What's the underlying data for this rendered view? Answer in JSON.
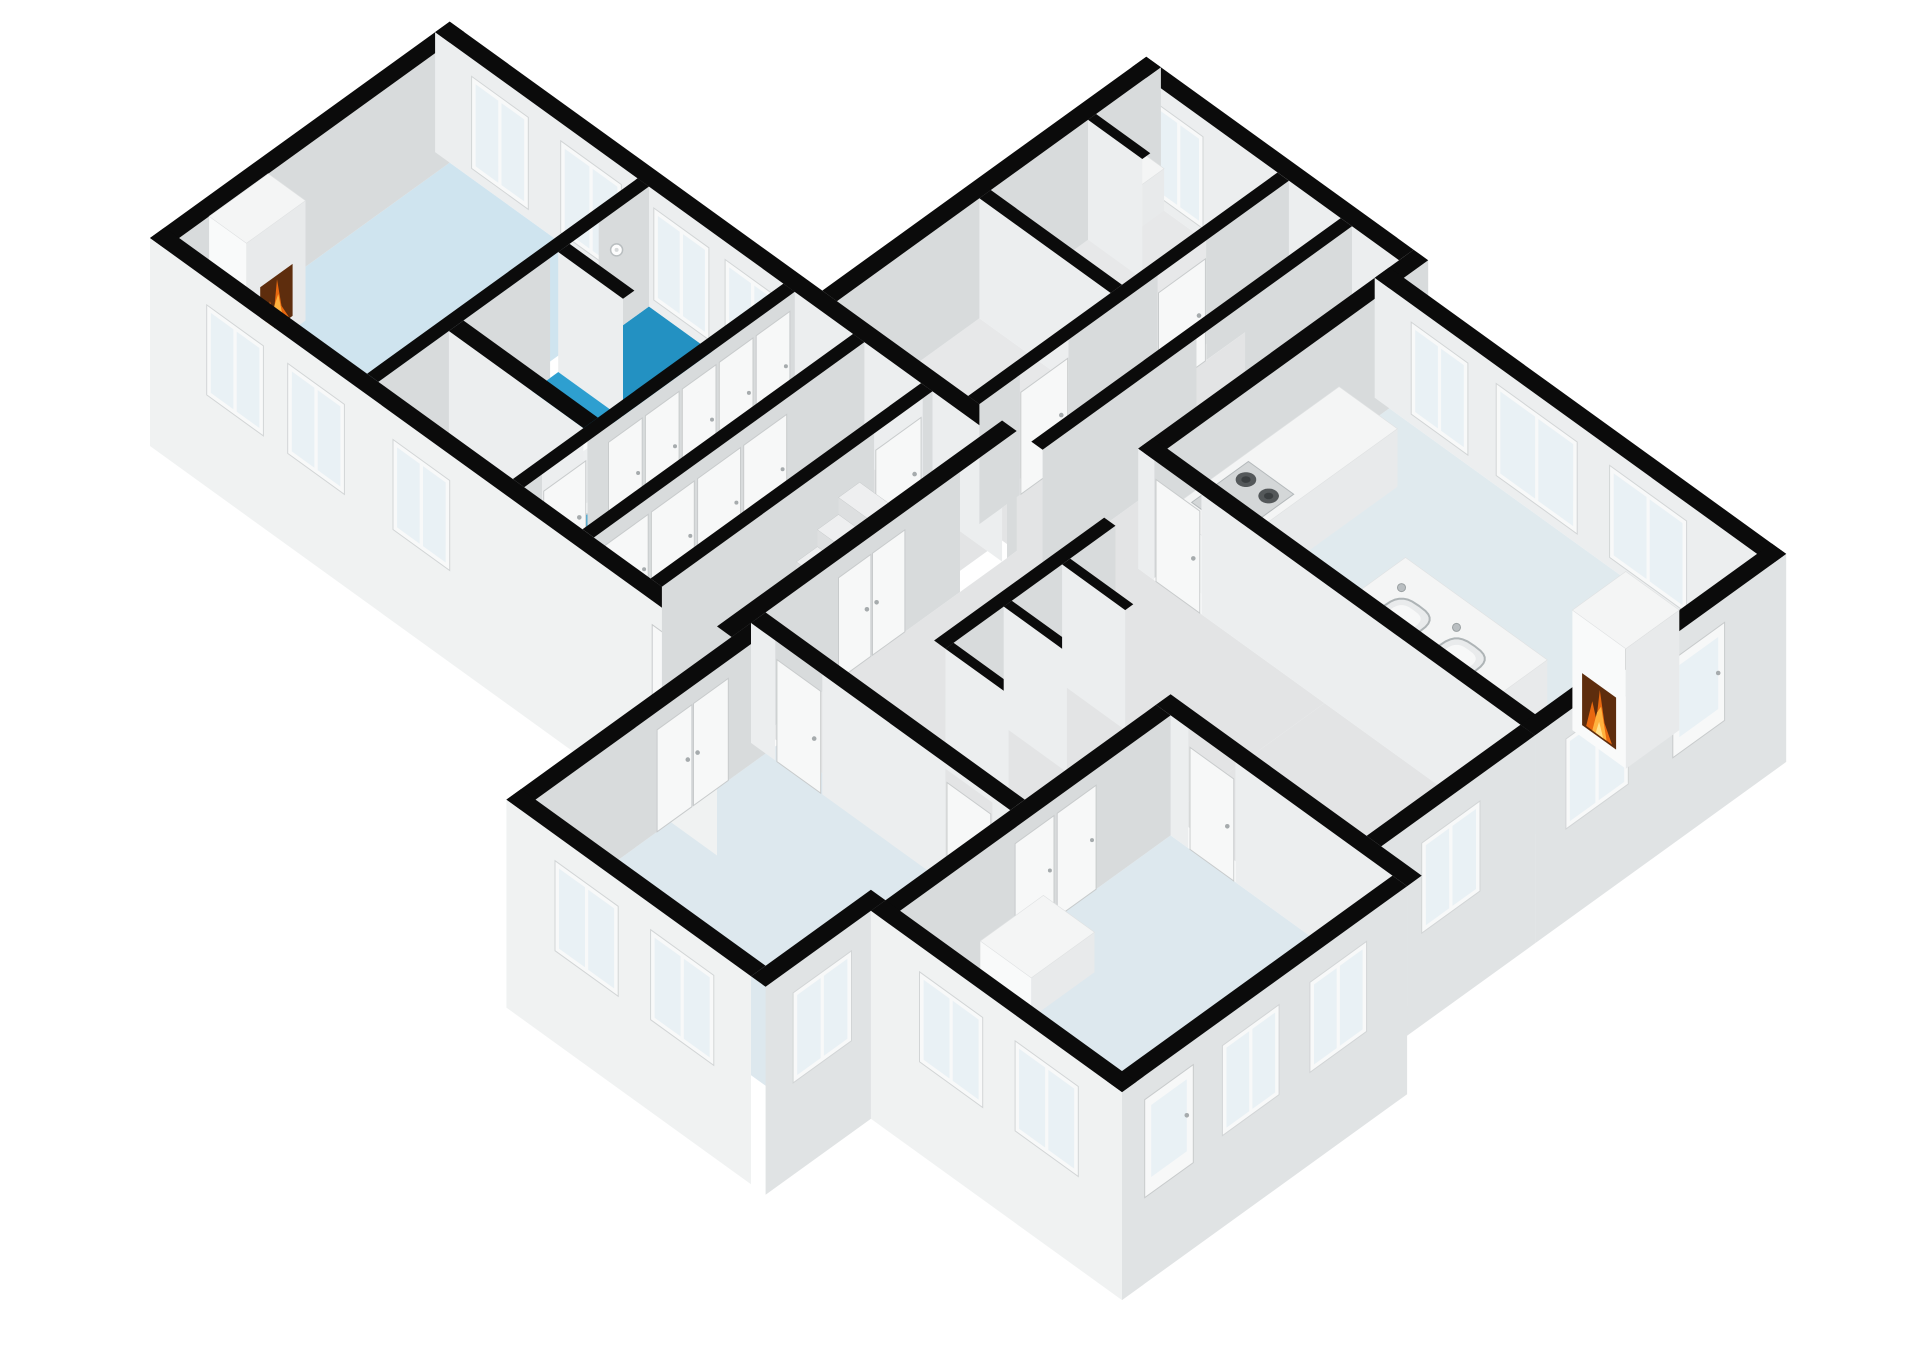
{
  "scene": {
    "label": "3D isometric floor plan rendering",
    "rooms": [
      {
        "name": "living-room",
        "floor": "floorLiving",
        "features": [
          "fireplace",
          "windows"
        ]
      },
      {
        "name": "bathroom",
        "floor": "floorBath",
        "features": [
          "bathtub",
          "shower-alcove",
          "shower-head"
        ]
      },
      {
        "name": "hall-strip",
        "floor": "floorGray",
        "features": [
          "window"
        ]
      },
      {
        "name": "wardrobe-corridor-1",
        "floor": "floorGray",
        "features": [
          "closet-doors"
        ]
      },
      {
        "name": "wardrobe-corridor-2",
        "floor": "floorGray",
        "features": [
          "closet-doors"
        ]
      },
      {
        "name": "stair-hall",
        "floor": "floorGray",
        "features": [
          "staircase",
          "red-decor",
          "exterior-door"
        ]
      },
      {
        "name": "small-room-a",
        "floor": "floorRoomGray",
        "features": [
          "door"
        ]
      },
      {
        "name": "small-room-b",
        "floor": "floorRoomGray",
        "features": [
          "storage-nook",
          "window"
        ]
      },
      {
        "name": "connecting-corridor",
        "floor": "floorGray",
        "features": [
          "doors"
        ]
      },
      {
        "name": "kitchen",
        "floor": "floorKitchen",
        "features": [
          "counter",
          "stove",
          "island",
          "double-sink",
          "fireplace",
          "windows",
          "glass-door"
        ]
      },
      {
        "name": "bottom-center-room",
        "floor": "floorRoom",
        "features": [
          "double-door",
          "windows"
        ]
      },
      {
        "name": "bottom-right-room",
        "floor": "floorRoom",
        "features": [
          "closet",
          "chest",
          "windows",
          "glass-door"
        ]
      }
    ]
  },
  "projection": {
    "x0": 150,
    "y0": 358,
    "kx": 0.81,
    "ky": 0.585,
    "wall_h": 120,
    "plinth": 88
  },
  "colors": {
    "bg": "#ffffff",
    "wallTop": "#0b0b0b",
    "faceSE": "#d8dbdc",
    "faceSW": "#eceeef",
    "extSE": "#e0e3e4",
    "extSW": "#f0f2f2",
    "boxTop": "#f4f5f5",
    "boxSW": "#f9fafa",
    "boxSE": "#e8eaeb",
    "redTop": "#d14b36",
    "redSW": "#c43b2a",
    "redSE": "#a93225",
    "floorLiving": "#cfe4ef",
    "floorBath": "#2e9fd0",
    "floorAlcove": "#2391c2",
    "floorGray": "#e3e4e5",
    "floorRoomGray": "#e7e8e9",
    "floorKitchen": "#e0eaee",
    "floorRoom": "#dde8ee",
    "glass": "#e9f1f5",
    "frame": "#f8f9f9",
    "frameEdge": "#d2d5d6",
    "doorFill": "#f7f8f8",
    "doorEdge": "#c8cbcc",
    "handle": "#a6abad",
    "stairTop": "#eeeff0",
    "stairFaceSW": "#dddfe0",
    "stairFaceSE": "#d2d4d5",
    "fireDark": "#5e2d0d",
    "fireMid": "#e8680f",
    "fireLight": "#ffb23e",
    "fireCore": "#ffe08a",
    "tubFill": "#fcfdfd",
    "tubEdge": "#cdd1d2",
    "tubInner": "#edeff0",
    "steel": "#b9bec1",
    "cooktop": "#d4d7d8",
    "burner": "#54585a",
    "burnerIn": "#3a3e40",
    "sinkRim": "#aeb4b6",
    "sinkIn": "#e9ebec",
    "sinkBowl": "#f7f8f8"
  },
  "elements": [
    {
      "kind": "floor",
      "name": "living-room-floor",
      "r": [
        18,
        18,
        352,
        250
      ],
      "c": "floorLiving"
    },
    {
      "kind": "floor",
      "name": "hall-strip-floor",
      "r": [
        18,
        264,
        105,
        430
      ],
      "c": "floorGray"
    },
    {
      "kind": "floor",
      "name": "bathroom-floor",
      "r": [
        123,
        264,
        352,
        430
      ],
      "c": "floorBath"
    },
    {
      "kind": "floor",
      "name": "shower-alcove-floor",
      "r": [
        254,
        264,
        352,
        344
      ],
      "c": "floorAlcove"
    },
    {
      "kind": "floor",
      "name": "wardrobe-corridor-1-floor",
      "r": [
        18,
        444,
        352,
        516
      ],
      "c": "floorGray"
    },
    {
      "kind": "floor",
      "name": "wardrobe-corridor-2-floor",
      "r": [
        18,
        530,
        352,
        600
      ],
      "c": "floorGray"
    },
    {
      "kind": "floor",
      "name": "stair-hall-floor",
      "r": [
        18,
        614,
        352,
        682
      ],
      "c": "floorGray"
    },
    {
      "kind": "floor",
      "name": "small-room-a-floor",
      "r": [
        370,
        478,
        546,
        640
      ],
      "c": "floorRoomGray"
    },
    {
      "kind": "floor",
      "name": "small-room-b-floor",
      "r": [
        560,
        478,
        752,
        640
      ],
      "c": "floorRoomGray"
    },
    {
      "kind": "floor",
      "name": "corridor-b-floor",
      "r": [
        370,
        654,
        752,
        718
      ],
      "c": "floorGray"
    },
    {
      "kind": "floor",
      "name": "transition-floor",
      "r": [
        370,
        732,
        752,
        790
      ],
      "c": "floorGray"
    },
    {
      "kind": "floor",
      "name": "middle-strip-floor",
      "r": [
        60,
        700,
        430,
        1020
      ],
      "c": "floorGray"
    },
    {
      "kind": "floor",
      "name": "middle-strip-2-floor",
      "r": [
        240,
        1020,
        430,
        1262
      ],
      "c": "floorGray"
    },
    {
      "kind": "floor",
      "name": "kitchen-floor",
      "r": [
        448,
        808,
        722,
        1262
      ],
      "c": "floorKitchen"
    },
    {
      "kind": "floor",
      "name": "bottom-center-room-floor",
      "r": [
        -242,
        718,
        60,
        1002
      ],
      "c": "floorRoom"
    },
    {
      "kind": "floor",
      "name": "bottom-right-room-floor",
      "r": [
        -112,
        1038,
        222,
        1312
      ],
      "c": "floorRoom"
    },
    {
      "kind": "wall",
      "name": "living-nw-exterior-wall",
      "dir": "u",
      "at": 0,
      "t": 18,
      "span": [
        0,
        370
      ]
    },
    {
      "kind": "wall",
      "name": "block-b-ne-exterior-wall",
      "dir": "v",
      "at": 752,
      "t": 18,
      "span": [
        460,
        790
      ],
      "win": [
        {
          "a": 488,
          "b": 548
        }
      ]
    },
    {
      "kind": "wall",
      "name": "block-b-nw-exterior-wall",
      "dir": "u",
      "at": 460,
      "t": 18,
      "span": [
        370,
        770
      ]
    },
    {
      "kind": "box",
      "name": "storage-nook-shelf",
      "r": [
        690,
        478,
        752,
        500
      ],
      "h": 42,
      "c": "box"
    },
    {
      "kind": "wall",
      "name": "storage-nook-partition",
      "dir": "v",
      "at": 680,
      "t": 10,
      "span": [
        478,
        545
      ]
    },
    {
      "kind": "wall",
      "name": "left-wing-ne-wall",
      "dir": "v",
      "at": 352,
      "t": 18,
      "span": [
        0,
        700
      ],
      "win": [
        {
          "a": 45,
          "b": 115
        },
        {
          "a": 155,
          "b": 230
        },
        {
          "a": 270,
          "b": 338
        },
        {
          "a": 358,
          "b": 426
        }
      ]
    },
    {
      "kind": "wall",
      "name": "room-a-b-divider-wall",
      "dir": "v",
      "at": 546,
      "t": 14,
      "span": [
        478,
        640
      ]
    },
    {
      "kind": "wall",
      "name": "living-bathroom-wall",
      "dir": "u",
      "at": 250,
      "t": 14,
      "span": [
        18,
        352
      ],
      "gaps": [
        [
          230,
          290
        ]
      ],
      "deco": [
        {
          "kind": "shower",
          "u": 312,
          "z": 80
        }
      ]
    },
    {
      "kind": "wall",
      "name": "shower-alcove-stub-wall",
      "dir": "v",
      "at": 240,
      "t": 14,
      "span": [
        264,
        344
      ]
    },
    {
      "kind": "wall",
      "name": "rooms-corridor-wall",
      "dir": "u",
      "at": 640,
      "t": 14,
      "span": [
        370,
        752
      ],
      "gaps": [
        [
          420,
          480
        ],
        [
          590,
          650
        ]
      ],
      "doors": [
        {
          "a": 421,
          "b": 479
        },
        {
          "a": 591,
          "b": 649
        }
      ]
    },
    {
      "kind": "wall",
      "name": "corridor-transition-wall",
      "dir": "u",
      "at": 718,
      "t": 14,
      "span": [
        370,
        752
      ],
      "gaps": [
        [
          560,
          620
        ]
      ]
    },
    {
      "kind": "tub",
      "name": "bathtub",
      "c": [
        182,
        372
      ],
      "ru": 64,
      "rv": 36
    },
    {
      "kind": "wall",
      "name": "kitchen-nw-wall",
      "dir": "u",
      "at": 790,
      "t": 18,
      "span": [
        430,
        770
      ]
    },
    {
      "kind": "wall",
      "name": "hall-bathroom-wall",
      "dir": "v",
      "at": 105,
      "t": 18,
      "span": [
        264,
        430
      ]
    },
    {
      "kind": "wall",
      "name": "bathroom-corridor-wall",
      "dir": "u",
      "at": 430,
      "t": 14,
      "span": [
        18,
        352
      ],
      "gaps": [
        [
          40,
          96
        ]
      ],
      "doors": [
        {
          "a": 42,
          "b": 94
        }
      ],
      "closets": [
        {
          "a": 120,
          "b": 348,
          "n": 5
        }
      ]
    },
    {
      "kind": "box",
      "name": "kitchen-counter",
      "r": [
        448,
        808,
        660,
        880
      ],
      "h": 58,
      "c": "box"
    },
    {
      "kind": "stove",
      "name": "stove-cooktop",
      "r": [
        470,
        816,
        540,
        872
      ],
      "z": 58
    },
    {
      "kind": "wall",
      "name": "kitchen-ne-wall",
      "dir": "v",
      "at": 722,
      "t": 18,
      "span": [
        790,
        1280
      ],
      "win": [
        {
          "a": 835,
          "b": 905
        },
        {
          "a": 940,
          "b": 1040
        },
        {
          "a": 1080,
          "b": 1175
        }
      ]
    },
    {
      "kind": "wall",
      "name": "corridor-1-2-wall",
      "dir": "u",
      "at": 516,
      "t": 14,
      "span": [
        18,
        352
      ],
      "closets": [
        {
          "a": 30,
          "b": 258,
          "n": 4
        }
      ]
    },
    {
      "kind": "wall",
      "name": "left-wing-sw-exterior-wall",
      "dir": "v",
      "at": 0,
      "t": 18,
      "span": [
        0,
        700
      ],
      "ext": true,
      "win": [
        {
          "a": 70,
          "b": 140
        },
        {
          "a": 170,
          "b": 240
        },
        {
          "a": 300,
          "b": 370
        }
      ],
      "doors": [
        {
          "a": 620,
          "b": 676
        }
      ]
    },
    {
      "kind": "wall",
      "name": "corridor-stairhall-wall",
      "dir": "u",
      "at": 600,
      "t": 14,
      "span": [
        18,
        352
      ],
      "gaps": [
        [
          280,
          340
        ]
      ],
      "doors": [
        {
          "a": 282,
          "b": 338
        }
      ]
    },
    {
      "kind": "box",
      "name": "kitchen-cabinet",
      "r": [
        448,
        880,
        496,
        940
      ],
      "h": 46,
      "c": "box"
    },
    {
      "kind": "stairs",
      "name": "staircase",
      "u0": 130,
      "n": 5,
      "w": 26,
      "v0": 616,
      "v1": 676,
      "h0": 16,
      "dh": 17
    },
    {
      "kind": "box",
      "name": "red-decor-item",
      "r": [
        106,
        652,
        122,
        668
      ],
      "h": 14,
      "c": "red"
    },
    {
      "kind": "wall",
      "name": "left-wing-se-wall",
      "dir": "u",
      "at": 682,
      "t": 18,
      "span": [
        18,
        370
      ],
      "gaps": [
        [
          300,
          358
        ]
      ],
      "doors": [
        {
          "a": 150,
          "b": 232,
          "double": true
        }
      ]
    },
    {
      "kind": "box",
      "name": "kitchen-island",
      "r": [
        470,
        990,
        560,
        1165
      ],
      "h": 52,
      "c": "box"
    },
    {
      "kind": "sinks",
      "name": "island-double-sink",
      "z": 52,
      "items": [
        [
          505,
          1040
        ],
        [
          505,
          1108
        ]
      ]
    },
    {
      "kind": "wall",
      "name": "nook-back-wall",
      "dir": "u",
      "at": 828,
      "t": 14,
      "span": [
        140,
        350
      ]
    },
    {
      "kind": "wall",
      "name": "kitchen-sw-wall",
      "dir": "v",
      "at": 430,
      "t": 18,
      "span": [
        790,
        1280
      ],
      "gaps": [
        [
          810,
          868
        ]
      ],
      "doors": [
        {
          "a": 812,
          "b": 866
        }
      ]
    },
    {
      "kind": "wall",
      "name": "nook-partition-1",
      "dir": "v",
      "at": 140,
      "t": 10,
      "span": [
        842,
        920
      ]
    },
    {
      "kind": "wall",
      "name": "nook-partition-2",
      "dir": "v",
      "at": 212,
      "t": 10,
      "span": [
        842,
        920
      ]
    },
    {
      "kind": "wall",
      "name": "nook-partition-3",
      "dir": "v",
      "at": 284,
      "t": 10,
      "span": [
        842,
        920
      ]
    },
    {
      "kind": "wall",
      "name": "kitchen-se-exterior-wall",
      "dir": "u",
      "at": 1262,
      "t": 18,
      "span": [
        430,
        740
      ],
      "ext": true,
      "win": [
        {
          "a": 468,
          "b": 545
        }
      ],
      "doors": [
        {
          "a": 600,
          "b": 664,
          "glass": true
        }
      ]
    },
    {
      "kind": "box",
      "name": "kitchen-fireplace-chimney",
      "r": [
        560,
        1196,
        626,
        1262
      ],
      "h": 120,
      "c": "box",
      "fire": {
        "face": "sw",
        "a1": 1208,
        "a2": 1250,
        "z1": 12,
        "z2": 64
      }
    },
    {
      "kind": "wall",
      "name": "bottom-center-nw-wall",
      "dir": "u",
      "at": 700,
      "t": 18,
      "span": [
        -260,
        42
      ],
      "doors": [
        {
          "a": -92,
          "b": -4,
          "double": true
        }
      ]
    },
    {
      "kind": "wall",
      "name": "center-room-corridor-wall",
      "dir": "v",
      "at": 42,
      "t": 18,
      "span": [
        700,
        1020
      ],
      "gaps": [
        [
          730,
          788
        ],
        [
          940,
          998
        ]
      ],
      "doors": [
        {
          "a": 732,
          "b": 786
        },
        {
          "a": 942,
          "b": 996
        }
      ]
    },
    {
      "kind": "wall",
      "name": "strip-se-exterior-wall",
      "dir": "u",
      "at": 1262,
      "t": 18,
      "span": [
        240,
        430
      ],
      "ext": true,
      "win": [
        {
          "a": 290,
          "b": 362
        }
      ]
    },
    {
      "kind": "wall",
      "name": "bottom-right-ne-wall",
      "dir": "v",
      "at": 222,
      "t": 18,
      "span": [
        1020,
        1330
      ],
      "gaps": [
        [
          1060,
          1118
        ]
      ],
      "doors": [
        {
          "a": 1062,
          "b": 1116
        }
      ]
    },
    {
      "kind": "wall",
      "name": "bottom-right-nw-wall",
      "dir": "u",
      "at": 1020,
      "t": 18,
      "span": [
        -130,
        222
      ],
      "closets": [
        {
          "a": 28,
          "b": 132,
          "n": 2
        }
      ]
    },
    {
      "kind": "box",
      "name": "white-storage-box",
      "r": [
        -20,
        1045,
        58,
        1108
      ],
      "h": 40,
      "c": "box"
    },
    {
      "kind": "wall",
      "name": "bottom-center-sw-exterior-wall",
      "dir": "v",
      "at": -260,
      "t": 18,
      "span": [
        700,
        1002
      ],
      "ext": true,
      "win": [
        {
          "a": 760,
          "b": 838
        },
        {
          "a": 878,
          "b": 956
        }
      ]
    },
    {
      "kind": "wall",
      "name": "bottom-center-se-exterior-wall",
      "dir": "u",
      "at": 1002,
      "t": 18,
      "span": [
        -260,
        -112
      ],
      "ext": true,
      "win": [
        {
          "a": -226,
          "b": -154
        }
      ]
    },
    {
      "kind": "box",
      "name": "white-chest",
      "r": [
        -118,
        1140,
        -58,
        1240
      ],
      "h": 42,
      "c": "box"
    },
    {
      "kind": "wall",
      "name": "bottom-right-se-exterior-wall",
      "dir": "u",
      "at": 1312,
      "t": 18,
      "span": [
        -130,
        222
      ],
      "ext": true,
      "doors": [
        {
          "a": -102,
          "b": -42,
          "glass": true
        }
      ],
      "win": [
        {
          "a": -6,
          "b": 64
        },
        {
          "a": 102,
          "b": 172
        }
      ]
    },
    {
      "kind": "wall",
      "name": "bottom-right-sw-exterior-wall",
      "dir": "v",
      "at": -130,
      "t": 18,
      "span": [
        1020,
        1330
      ],
      "ext": true,
      "win": [
        {
          "a": 1080,
          "b": 1158
        },
        {
          "a": 1198,
          "b": 1276
        }
      ]
    }
  ],
  "fireplace_living": {
    "name": "living-room-fireplace-chimney",
    "r": [
      55,
      18,
      128,
      64
    ],
    "h": 120,
    "fire": {
      "face": "se",
      "a1": 72,
      "a2": 112,
      "z1": 14,
      "z2": 66
    }
  }
}
